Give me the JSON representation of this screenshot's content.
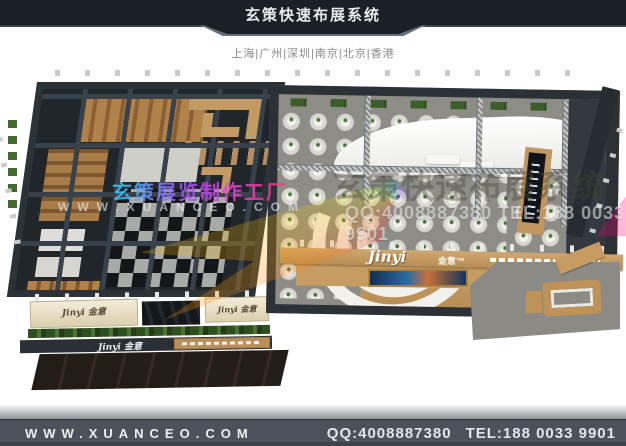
{
  "header": {
    "title": "玄策快速布展系统",
    "cities": "上海|广州|深圳|南京|北京|香港"
  },
  "booth": {
    "sign_left_a": "Jinyi 金意",
    "sign_left_b": "Jinyi 金意",
    "band_logo": "Jinyi 金意",
    "fascia_script": "Jinyi",
    "fascia_cn": "金意™"
  },
  "watermarks": {
    "factory_line": "玄策展览制作工厂",
    "website_spaced": "WWW.XUANCEO.COM",
    "system_line": "玄策快速布展系统",
    "contact_line": "QQ:4008887380 TEL:188 0033 9901"
  },
  "footer": {
    "website": "WWW.XUANCEO.COM",
    "qq": "QQ:4008887380",
    "tel": "TEL:188 0033 9901"
  },
  "colors": {
    "header_bg": "#1b1f26",
    "footer_bg": "#4d525a",
    "frame": "#2b3136",
    "carpet": "#8d8c86",
    "wood": "#c49a66",
    "cream": "#efe6cd",
    "hedge": "#3c5f2a"
  }
}
